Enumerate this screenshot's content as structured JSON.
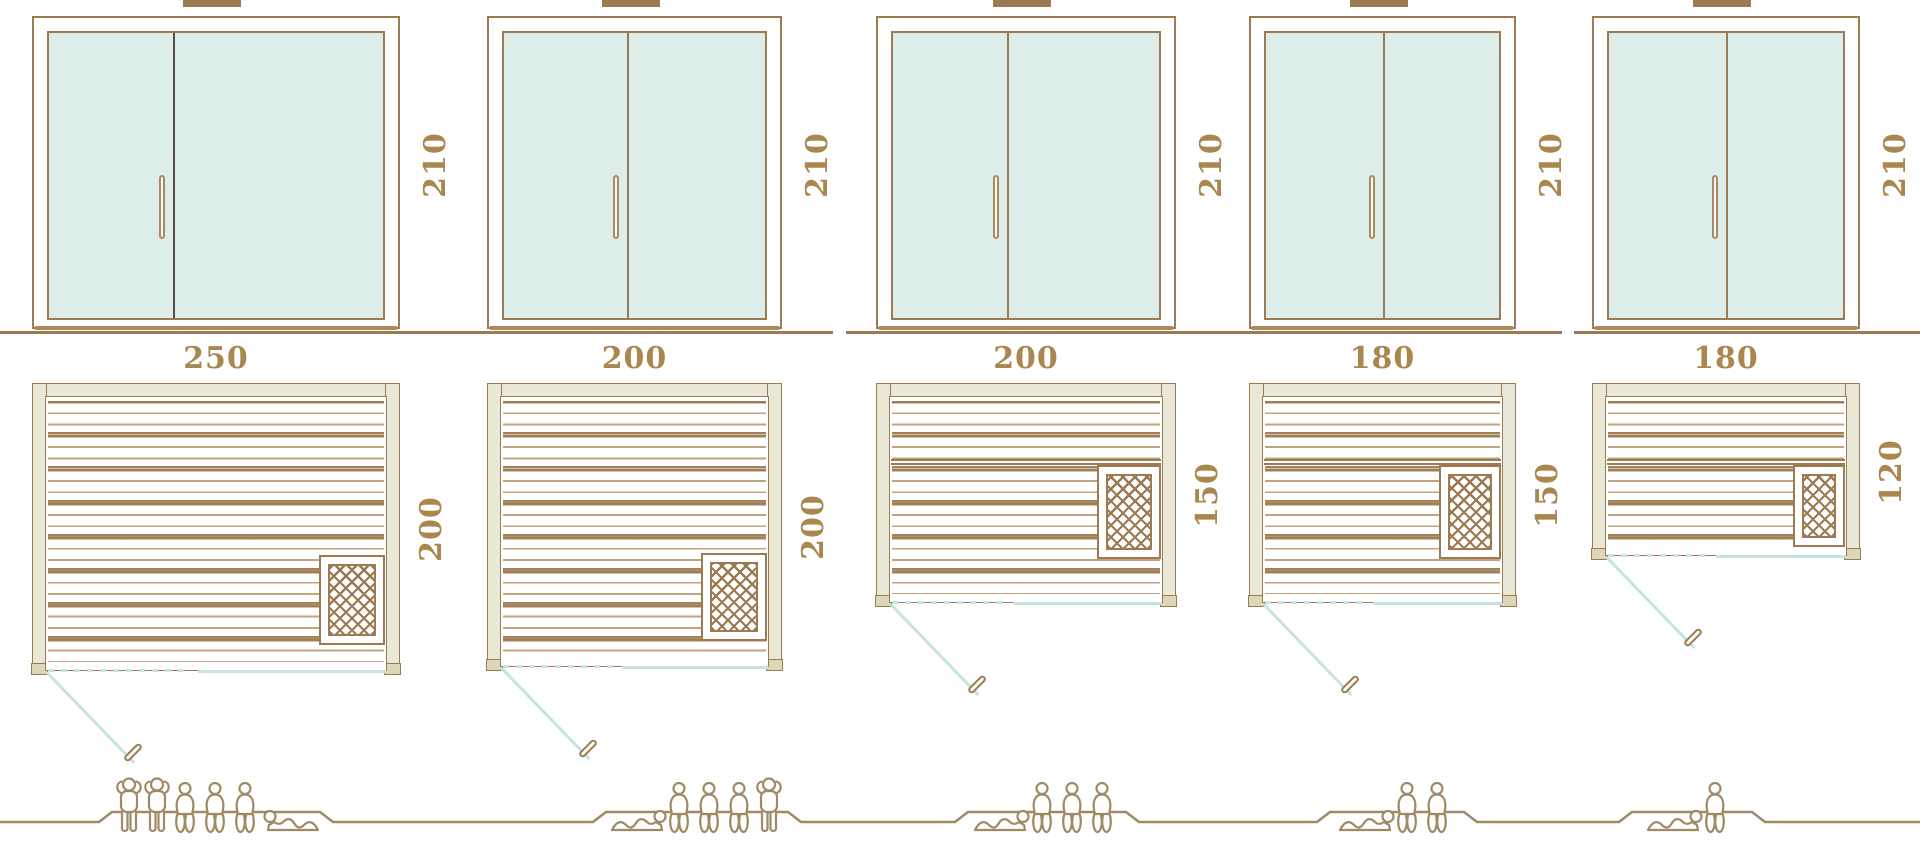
{
  "diagram": {
    "kind": "sauna size comparison — front door elevations, floor plans and seating capacity",
    "door_height_label_all_models": "210"
  },
  "colors": {
    "outline_brown": "#9c7b52",
    "light_brown": "#aa8a5e",
    "stripe_brown": "#b99a72",
    "label_text": "#a9874f",
    "glass_teal": "#ddeeea",
    "wall_fill": "#eae8d6",
    "door_swing_teal": "#c6e4e0",
    "people_brown": "#a08a66",
    "door_divider_dark": "#55504a"
  },
  "icons": {
    "standing": "person-standing-icon",
    "sitting": "person-sitting-icon",
    "lying": "person-lying-icon",
    "heater": "heater-grill-icon",
    "door_handle": "door-handle-icon"
  },
  "models": [
    {
      "height_label": "210",
      "width_label": "250",
      "depth_label": "200",
      "capacity": 6,
      "people": [
        "person-standing",
        "person-standing",
        "person-sitting",
        "person-sitting",
        "person-sitting",
        "person-lying"
      ]
    },
    {
      "height_label": "210",
      "width_label": "200",
      "depth_label": "200",
      "capacity": 5,
      "people": [
        "person-lying",
        "person-sitting",
        "person-sitting",
        "person-sitting",
        "person-standing"
      ]
    },
    {
      "height_label": "210",
      "width_label": "200",
      "depth_label": "150",
      "capacity": 4,
      "people": [
        "person-lying",
        "person-sitting",
        "person-sitting",
        "person-sitting"
      ]
    },
    {
      "height_label": "210",
      "width_label": "180",
      "depth_label": "150",
      "capacity": 3,
      "people": [
        "person-lying",
        "person-sitting",
        "person-sitting"
      ]
    },
    {
      "height_label": "210",
      "width_label": "180",
      "depth_label": "120",
      "capacity": 2,
      "people": [
        "person-lying",
        "person-sitting"
      ]
    }
  ]
}
